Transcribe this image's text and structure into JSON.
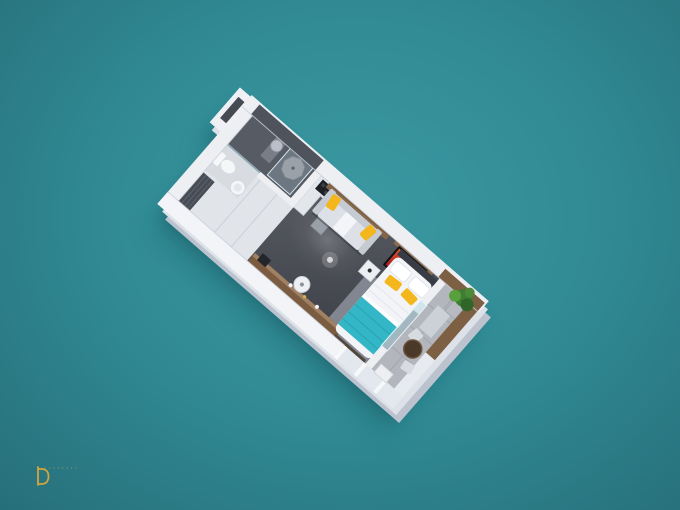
{
  "meta": {
    "type": "3d-floorplan-render",
    "view": "isometric-top-down-studio-apartment"
  },
  "background": {
    "base": "#318b95",
    "center": "#3b98a1",
    "edge": "#266f7a"
  },
  "logo": {
    "monogram": "D",
    "wordmark": "••••••••",
    "color": "#cda43e"
  },
  "scene": {
    "rotation_deg": 41,
    "rooms": [
      {
        "name": "bathroom",
        "floor_color": "#565b64",
        "features": [
          "dark-tile-wall",
          "glass-shower",
          "shower-tray",
          "vanity-column",
          "mirror"
        ]
      },
      {
        "name": "wet-area",
        "floor_color": "#d8dbe0",
        "features": [
          "toilet",
          "pedestal-sink"
        ]
      },
      {
        "name": "entry-hall",
        "floor_color": "#e1e4e9",
        "features": [
          "wardrobe"
        ]
      },
      {
        "name": "kitchen",
        "floor_color": "#e3e6ea",
        "features": [
          "l-shaped-counter",
          "cooktop",
          "sink",
          "fridge-column"
        ]
      },
      {
        "name": "living-sleeping-area",
        "floor_color": "#44474f",
        "features": [
          "sofa-with-yellow-pillows",
          "wood-wall-panel",
          "tv-with-red-artwork",
          "double-bed-teal-blanket",
          "rug",
          "wood-sideboard",
          "round-side-table",
          "nightstand"
        ]
      },
      {
        "name": "balcony",
        "floor_color": "#b3b7bd",
        "features": [
          "potted-plant",
          "round-table",
          "chairs",
          "storage-cabinet",
          "glass-balustrade",
          "wood-accent-wall"
        ]
      }
    ],
    "palette": {
      "walls": "#eef0f4",
      "wall_shadow": "#c9cfd9",
      "wood": "#8a6b4e",
      "sofa": "#dde0e6",
      "accent_yellow": "#f3b71d",
      "bed_teal": "#34b7c6",
      "dark_floor": "#44474f",
      "concrete": "#b3b7bd",
      "plant_green": "#4c8a38",
      "tv_art_red": "#b02e2e",
      "shadow_teal": "#11525c"
    }
  }
}
